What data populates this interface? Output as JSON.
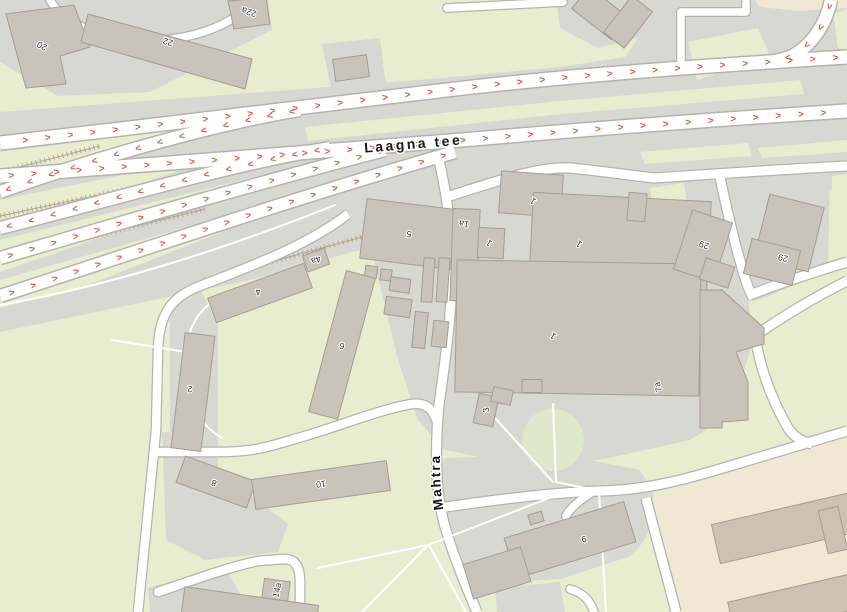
{
  "map": {
    "street_labels": {
      "laagna_tee": "Laagna tee",
      "mahtra": "Mahtra"
    },
    "one_way_arrows": {
      "eastbound": "> > > > > > > > > > > > > > > > > > > > > > > > > > > > > > > > > > > > > > > > > > > > > > > > > >",
      "westbound": "< < < < < < < < < < < < < < < < < < < < < < < < < < < < < < < < < < < < < < < < < < < < < < < < < <"
    },
    "building_labels": {
      "b20": "20",
      "b22": "22",
      "b22a": "22a",
      "b2": "2",
      "b4": "4",
      "b4a": "4a",
      "b6": "6",
      "b8": "8",
      "b10": "10",
      "b14a": "14a",
      "b5": "5",
      "b1a": "1a",
      "b1_north": "1",
      "b1_west": "1",
      "b1_east": "1",
      "b1_south": "1",
      "b7a": "7a",
      "b3": "3",
      "b29_west": "29",
      "b29_east": "29",
      "b9": "9"
    },
    "colors": {
      "grass": "#e8edd0",
      "paved": "#d8d8d2",
      "building": "#c9c4bb",
      "building_outline": "#a39d92",
      "school_ground": "#f0e8d5",
      "road_fill": "#ffffff",
      "road_casing": "#b4b4ae",
      "oneway_arrow": "#dd5b41",
      "embankment": "#b3a58f"
    }
  }
}
